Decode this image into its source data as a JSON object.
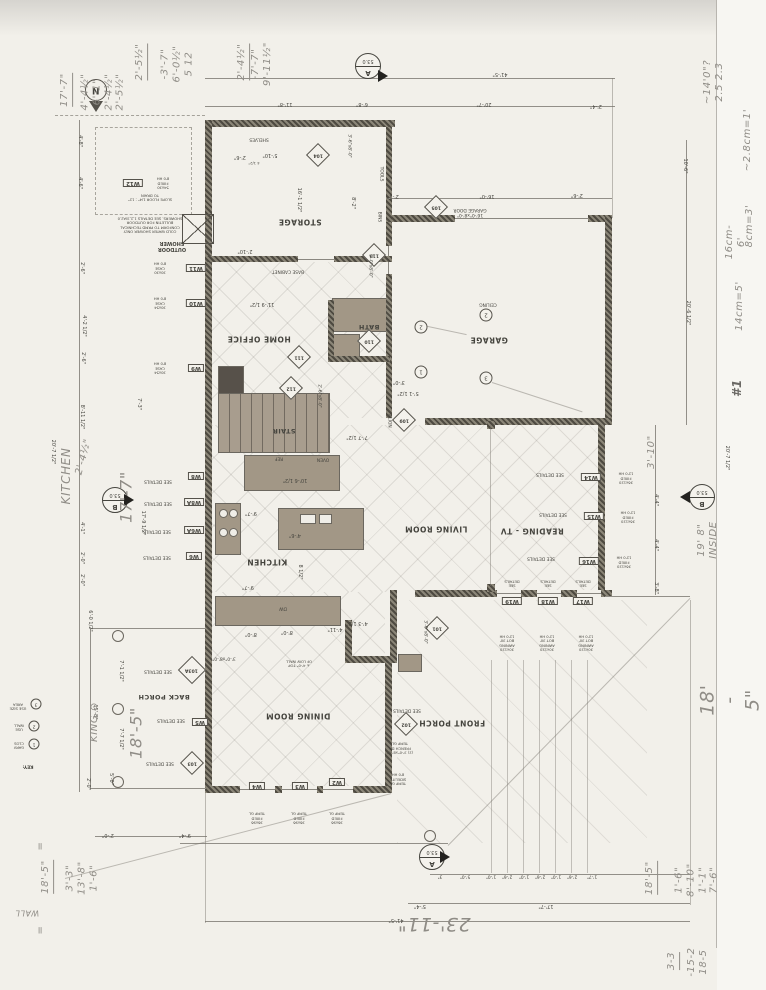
{
  "rooms": {
    "storage": "STORAGE",
    "garage": "GARAGE",
    "bath": "BATH",
    "home_office": "HOME OFFICE",
    "stair": "STAIR",
    "kitchen": "KITCHEN",
    "living": "LIVING ROOM",
    "reading": "READING - TV",
    "dining": "DINING ROOM",
    "back_porch": "BACK PORCH",
    "front_porch": "FRONT PORCH"
  },
  "fixtures": {
    "shelves": "SHELVES",
    "tools": "TOOLS",
    "bins": "BINS",
    "base_cabinet": "BASE CABINET",
    "oven": "OVEN",
    "ref": "REF",
    "dw": "DW",
    "ceiling": "CEILING",
    "align": "ALIGN",
    "outdoor_shower": "OUTDOOR\nSHOWER",
    "shower_note": "COLD WATER SHOWER ONLY\nCONFORM TO PRMD TECHNICAL\nBULLETIN FOR OUTDOOR\nSHOWERS. SEE DETAILS 1,2,3/A2.0",
    "slope_note": "SLOPE FLOOR 1/4\" : 12\"\nTO DRAIN",
    "low_wall_note": "± 4'-0\" TOP\nOF LOW WALL"
  },
  "doors": {
    "d101": "101",
    "d102": "102",
    "d103": "103",
    "d103a": "103A",
    "d104": "104",
    "d105": "105",
    "d109": "109",
    "d110": "110",
    "d111": "111",
    "d112": "112",
    "d113": "113",
    "garage_door_label": "16'-0\"x8'-0\"\nGARAGE DOOR",
    "d101_size": "3'-0\"x8'-0\"",
    "d113_size": "3'-0\"x8'-0\"",
    "d112_size": "2'-6\"x8'-0\"",
    "back_door_size": "3'-0\"x8'-0\"",
    "storage_door_size": "3'-6\"x8'-0\""
  },
  "windows": {
    "w12_id": "W12",
    "w12_spec": "54x30\nFIXED\n8'0 HH",
    "w11_id": "W11",
    "w11_spec": "30x30\nCASE\n8'0 HH",
    "w10_id": "W10",
    "w10_spec": "30x54\nCASE\n8'0 HH",
    "w9_id": "W9",
    "w9_spec": "30x54\nCASE\n8'0 HH",
    "w8_id": "W8",
    "w8a_id": "W8A",
    "w6a_id": "W6A",
    "w6_id": "W6",
    "w5_id": "W5",
    "w4_id": "W4",
    "w3_id": "W3",
    "w2_id": "W2",
    "w14_id": "W14",
    "w15_id": "W15",
    "w16_id": "W16",
    "w17_id": "W17",
    "w18_id": "W18",
    "w19_id": "W19",
    "fixed_spec": "36x96\nFIXED\nTEMP GL",
    "tall_fixed_spec": "36x120\nFIXED\n12'0 HH",
    "awning_spec": "30x120\nAWNING\nBOT 30'\n12'0 HH",
    "see_details": "SEE DETAILS",
    "see_details_2": "SEE\nDETAILS",
    "sidelite": "TEMP GL\nSIDELITE\n8'0 HH",
    "french_door": "(2) 3'-0\"x8'-0\"\nFRENCH DR\nTEMP GL"
  },
  "dims": {
    "top_total": "41'-5\"",
    "top_1": "11'-8\"",
    "top_2": "6'-8\"",
    "top_3": "20'-7\"",
    "top_4": "2'-4\"",
    "gar_1": "2'-1\"",
    "gar_2": "16'-0\"",
    "gar_3": "2'-6\"",
    "right_1": "10'-6\"",
    "right_2": "20'-6 1/2\"",
    "right_3": "20'-7 1/2\"",
    "right_4": "4'-4\"",
    "right_5": "4'-4\"",
    "right_6": "3'-8\"",
    "left_1": "4'-8\"",
    "left_2": "4'-6\"",
    "left_3": "2'-6\"",
    "left_4": "4'-2 1/2\"",
    "left_5": "2'-6\"",
    "left_6": "8'-11 1/2\"",
    "left_7": "4'-1\"",
    "left_8": "2'-0\"",
    "left_9": "2'-0\"",
    "left_10": "6'-0 1/2\"",
    "left_11": "7'-1 1/2\"",
    "left_12": "15'-8\"",
    "left_13": "7'-7 1/2\"",
    "left_14": "5'-0\"",
    "left_15": "2'-0\"",
    "left_16": "20'-7 1/2\"",
    "left_in_1": "7'-3\"",
    "left_in_2": "17'-9 1/2\"",
    "stor_1": "2'-6\"",
    "stor_2": "5'-10\"",
    "stor_3": "4 1/2\"",
    "stor_4": "16'-1 1/2\"",
    "stor_5": "8'-2\"",
    "base_cab": "2'-10\"",
    "office_1": "11'-9 1/2\"",
    "stair_1": "3'-0\"",
    "stair_2": "5'-1 1/2\"",
    "stair_3": "7'-7 1/2\"",
    "kit_1": "10'-6 1/2\"",
    "kit_2": "9'-7\"",
    "kit_3": "4'-6\"",
    "kit_4": "8 1/2\"",
    "kit_5": "9'-7\"",
    "kit_6": "8'-0\"",
    "din_1": "8'-0\"",
    "din_2": "4'-11\"",
    "din_3": "4'-3 1/2\"",
    "bot_1": "1'-7\"",
    "bot_2": "2'-6\"",
    "bot_3": "1'-0\"",
    "bot_4": "2'-6\"",
    "bot_5": "1'-0\"",
    "bot_6": "2'-6\"",
    "bot_7": "1'-0\"",
    "bot_8": "5'-0\"",
    "bot_9": "3\"",
    "bot_10": "17'-7\"",
    "bot_11": "5'-4\"",
    "bot_12": "41'-5\"",
    "bl_1": "2'-0\"",
    "bl_2": "9'-4\""
  },
  "markers": {
    "north": "N",
    "sec_a": "A",
    "sec_b": "B",
    "sheet": "53.0",
    "c1": "1",
    "c2": "2",
    "c3": "3",
    "c4": "2"
  },
  "key": {
    "title": "KEY:",
    "i1_n": "1",
    "i1": "GARV\nCLOS",
    "i2_n": "2",
    "i2": "USE\nWALL",
    "i3_n": "3",
    "i3": "USE SIZE\nAREA"
  },
  "hand": {
    "nw_total": "17'-7\"",
    "nw_list": "4'-4½\"\n6'-1\"\n2'-4½\"\n2'-5½\"",
    "a_res": "2'-5½\"",
    "a_list": "-3'-7\"\n6'-0½\"\n5 12",
    "b_res": "2'-4½\"",
    "b_list": "-7'-7\"\n9'-11½\"",
    "tr": "~14'0\"?\n2.5  2.3",
    "cm1": "~2.8cm=1'",
    "cm2": "8cm=3'",
    "cm3": "16cm-6'",
    "cm4": "14cm=5'",
    "num1": "#1",
    "inside": "19' 8\" INSIDE",
    "right_big": "18' - 5\"",
    "br1_res": "18'-5\"",
    "br1_list": "1'-6\"\n8'-10\"\n1'-1\"\n7'-6\"",
    "br2_res": "3-3",
    "br2_list": "-15-2\n18-5",
    "bl_res": "18'-5\"",
    "bl_list": "3'-3\"\n13'-8\"\n1'-6\"",
    "kitchen_word": "KITCHEN",
    "kitchen_dim": "17'-7\"",
    "king_word": "KING ⊙",
    "king_dim": "18'-5\"",
    "bottom_big": "23'-11\"",
    "small_1": "2'-4½\"",
    "dim_310": "3'-10\"",
    "wall_note": "WALL",
    "eq": "="
  }
}
